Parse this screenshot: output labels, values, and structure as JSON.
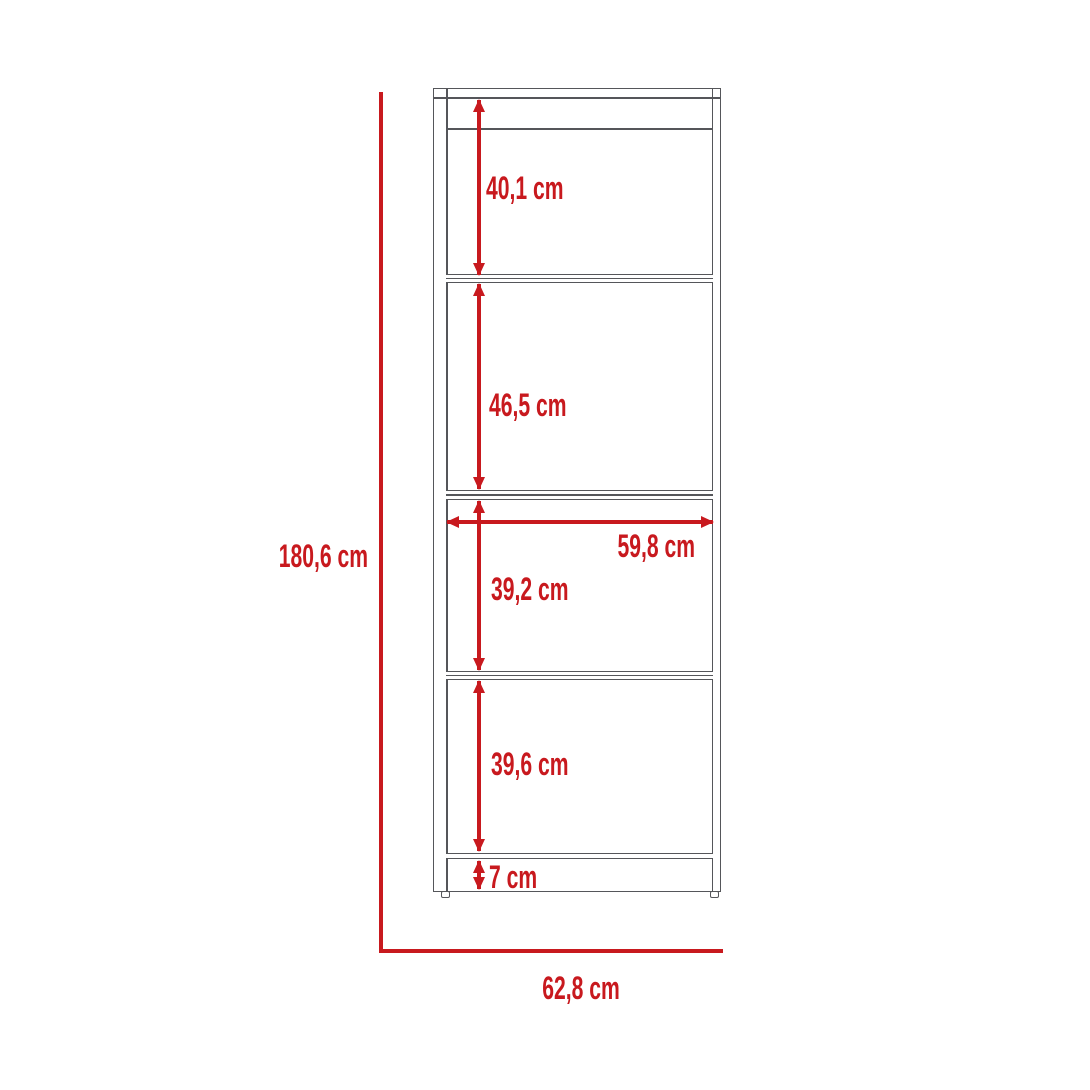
{
  "colors": {
    "dimension_red": "#C8191E",
    "outline_gray": "#55565A"
  },
  "labels": {
    "overall_height": "180,6 cm",
    "overall_width": "62,8 cm",
    "inner_width": "59,8 cm",
    "section_1": "40,1 cm",
    "section_2": "46,5 cm",
    "section_3": "39,2 cm",
    "section_4": "39,6 cm",
    "base_height": "7 cm"
  }
}
